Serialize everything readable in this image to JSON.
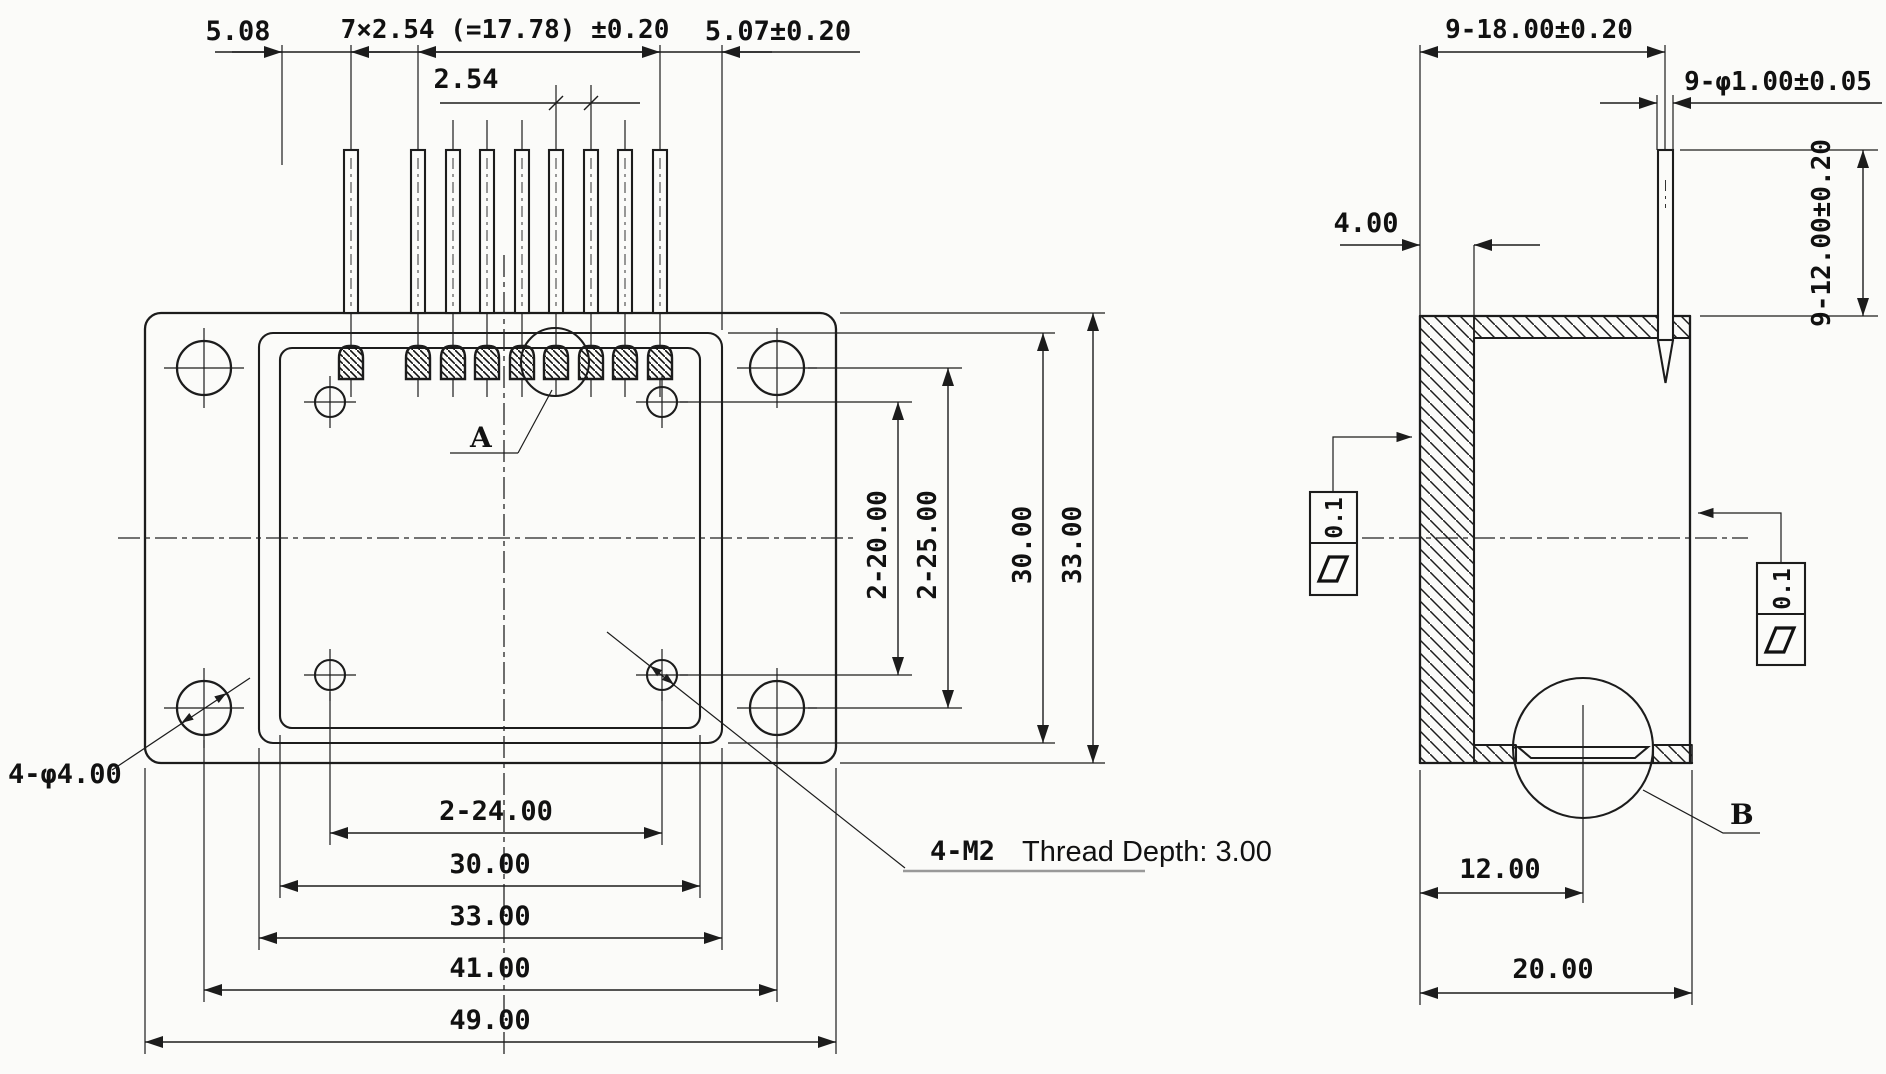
{
  "drawing": {
    "type": "mechanical-engineering-drawing",
    "background": "#fbfbf9",
    "line_color": "#1c1c1c",
    "units": "mm"
  },
  "left_view": {
    "dims_top": {
      "offset_left": "5.08",
      "pitch_total": "7×2.54 (=17.78) ±0.20",
      "pitch_single": "2.54",
      "offset_right": "5.07±0.20"
    },
    "dims_right": {
      "thread_hole_spacing_v": "2-20.00",
      "mount_hole_spacing_v": "2-25.00",
      "body_height": "30.00",
      "flange_height": "33.00"
    },
    "dims_bottom": {
      "thread_hole_spacing_h": "2-24.00",
      "cavity_width": "30.00",
      "body_width": "33.00",
      "mount_hole_spacing_h": "41.00",
      "flange_width": "49.00"
    },
    "labels": {
      "mount_holes": "4-φ4.00",
      "thread_holes": "4-M2",
      "thread_note": "Thread Depth: 3.00",
      "detail_a": "A"
    },
    "pin_count": 9
  },
  "right_view": {
    "dims": {
      "pin_row_span": "9-18.00±0.20",
      "pin_diameter": "9-φ1.00±0.05",
      "pin_protrusion": "9-12.00±0.20",
      "wall_thickness": "4.00",
      "window_offset": "12.00",
      "overall_depth": "20.00"
    },
    "labels": {
      "detail_b": "B"
    },
    "tolerance_frames": {
      "left_value": "0.1",
      "right_value": "0.1",
      "symbol": "flatness-parallelogram"
    }
  }
}
